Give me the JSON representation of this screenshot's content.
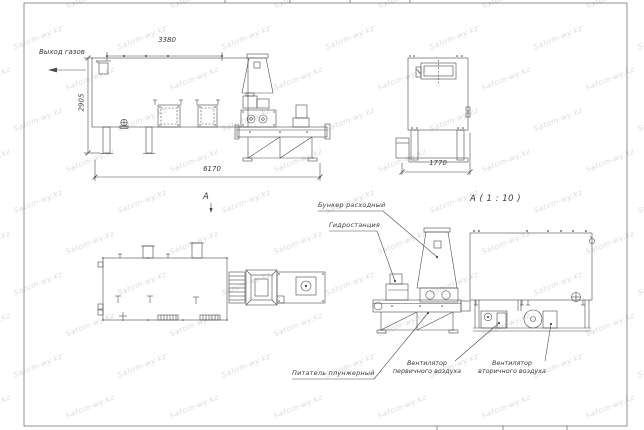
{
  "watermark": {
    "text": "Satom-wy.kz"
  },
  "labels": {
    "gas_outlet": "Выход газов",
    "section": "A",
    "detail_title": "A ( 1 : 10 )",
    "hopper": "Бункер расходный",
    "hydraulic_station": "Гидростанция",
    "plunger_feeder": "Питатель плунжерный",
    "primary_fan": [
      "Вентилятор",
      "первичного воздуха"
    ],
    "secondary_fan": [
      "Вентилятор",
      "вторичного воздуха"
    ]
  },
  "dimensions": {
    "top_width": "3380",
    "height": "2905",
    "total_length": "6170",
    "end_width": "1770"
  },
  "colors": {
    "line": "#4a4a4a",
    "text": "#3a3a3a",
    "watermark": "#96a2b0",
    "background": "#ffffff"
  }
}
